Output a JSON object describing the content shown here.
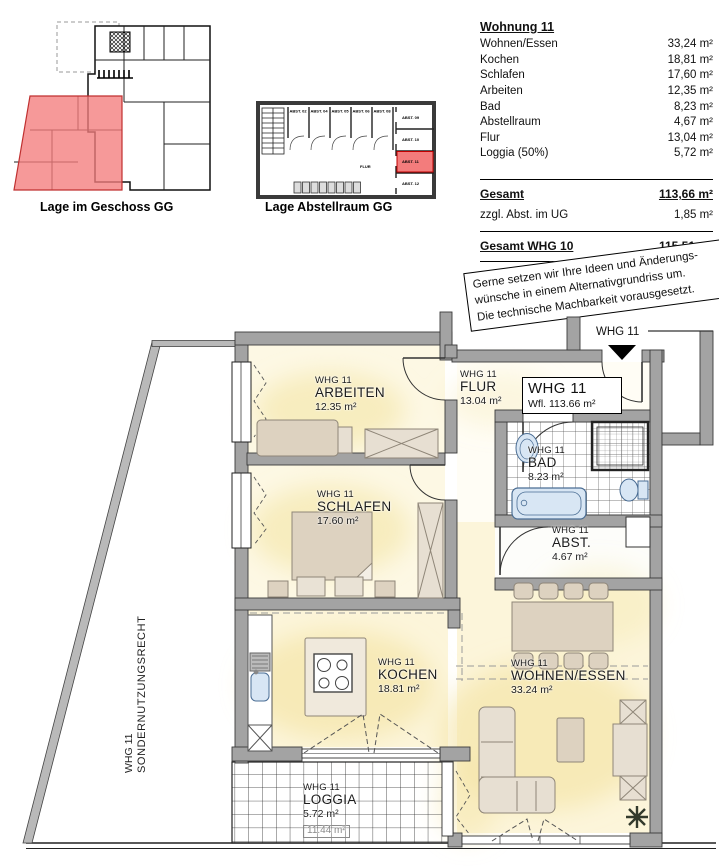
{
  "captions": {
    "geschoss": "Lage im Geschoss GG",
    "abstellraum": "Lage Abstellraum GG"
  },
  "area_table": {
    "title": "Wohnung 11",
    "rows": [
      {
        "label": "Wohnen/Essen",
        "value": "33,24 m²"
      },
      {
        "label": "Kochen",
        "value": "18,81 m²"
      },
      {
        "label": "Schlafen",
        "value": "17,60 m²"
      },
      {
        "label": "Arbeiten",
        "value": "12,35 m²"
      },
      {
        "label": "Bad",
        "value": "8,23 m²"
      },
      {
        "label": "Abstellraum",
        "value": "4,67 m²"
      },
      {
        "label": "Flur",
        "value": "13,04 m²"
      },
      {
        "label": "Loggia (50%)",
        "value": "5,72 m²"
      }
    ],
    "gesamt": {
      "label": "Gesamt",
      "value": "113,66 m²"
    },
    "zusatz": {
      "label": "zzgl. Abst. im UG",
      "value": "1,85 m²"
    },
    "gesamt_whg": {
      "label": "Gesamt WHG 10",
      "value": "115,51 m²"
    }
  },
  "note": {
    "line1": "Gerne setzen wir Ihre Ideen und Änderungs-",
    "line2": "wünsche in einem Alternativgrundriss um.",
    "line3": "Die technische Machbarkeit vorausgesetzt."
  },
  "storage_plan": {
    "cells_top": [
      "ABST. 02",
      "ABST. 04",
      "ABST. 05",
      "ABST. 06",
      "ABST. 08"
    ],
    "cells_right": [
      "ABST. 09",
      "ABST. 10",
      "ABST. 11",
      "ABST. 12"
    ],
    "corridor_label": "FLUR"
  },
  "plan": {
    "entrance_label": "WHG 11",
    "info_box": {
      "line1": "WHG 11",
      "line2": "Wfl. 113.66 m²"
    },
    "sondernutzung": {
      "line1": "WHG 11",
      "line2": "SONDERNUTZUNGSRECHT"
    },
    "rooms": {
      "flur": {
        "whg": "WHG 11",
        "name": "FLUR",
        "area": "13.04 m²"
      },
      "arbeiten": {
        "whg": "WHG 11",
        "name": "ARBEITEN",
        "area": "12.35 m²"
      },
      "schlafen": {
        "whg": "WHG 11",
        "name": "SCHLAFEN",
        "area": "17.60 m²"
      },
      "bad": {
        "whg": "WHG 11",
        "name": "BAD",
        "area": "8.23 m²"
      },
      "abstellraum": {
        "whg": "WHG 11",
        "name": "ABST.",
        "area": "4.67 m²"
      },
      "kochen": {
        "whg": "WHG 11",
        "name": "KOCHEN",
        "area": "18.81 m²"
      },
      "wohnen": {
        "whg": "WHG 11",
        "name": "WOHNEN/ESSEN",
        "area": "33.24 m²"
      },
      "loggia": {
        "whg": "WHG 11",
        "name": "LOGGIA",
        "area": "5.72 m²",
        "gross": "11.44 m²"
      }
    }
  },
  "colors": {
    "highlight": "#f37c7c",
    "wall_gray": "#a3a3a3",
    "glow_yellow": "#f3e3a0"
  }
}
